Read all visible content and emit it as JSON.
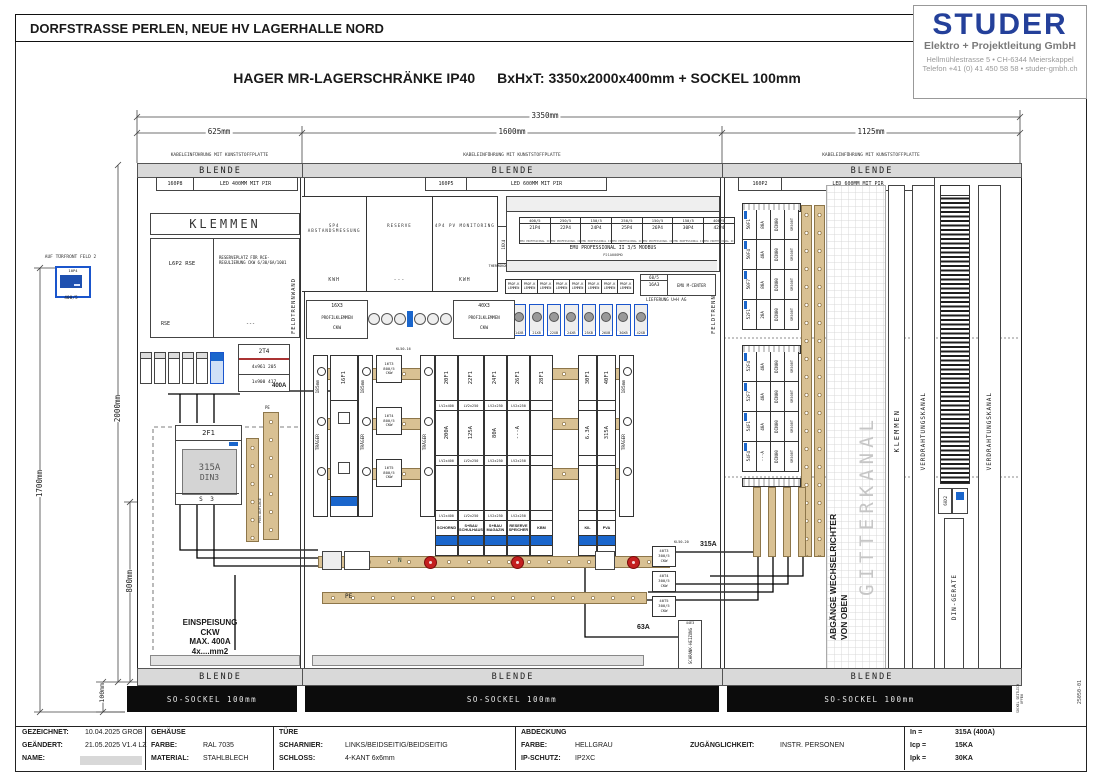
{
  "sheet": {
    "title": "DORFSTRASSE PERLEN, NEUE HV LAGERHALLE NORD",
    "subtitle_product": "HAGER MR-LAGERSCHRÄNKE IP40",
    "subtitle_dims": "BxHxT: 3350x2000x400mm + SOCKEL 100mm",
    "drawing_no": "25050-01"
  },
  "logo": {
    "name": "STUDER",
    "line1": "Elektro + Projektleitung GmbH",
    "line2": "Hellmühlestrasse 5  •  CH-6344 Meierskappel",
    "line3": "Telefon +41 (0) 41 450 58 58  •  studer-gmbh.ch",
    "color": "#24409a"
  },
  "dims": {
    "total": "3350mm",
    "f1": "625mm",
    "f2": "1600mm",
    "f3": "1125mm",
    "h_total": "2000mm",
    "h_door": "1700mm",
    "h_low": "800mm",
    "h_sockel": "100mm",
    "rail_pitch": "185mm"
  },
  "door_meter": {
    "note": "AUF TÜRFRONT FELD 2",
    "id": "10P4",
    "ct": "400/5"
  },
  "common": {
    "kabel_note": "KABELEINFÜHRUNG MIT KUNSTSTOFFPLATTE",
    "blende": "BLENDE",
    "feldtrennwand": "FELDTRENNWAND",
    "traeger": "TRÄGER",
    "sockel": "SO-SOCKEL 100mm",
    "sockel_note": "SOCKEL SEITLICH OFFEN",
    "n_label": "N",
    "pe_label": "PE"
  },
  "field1": {
    "light_id": "160P8",
    "light": "LED 400MM MIT PIR",
    "klemmen": "KLEMMEN",
    "rse": {
      "tl": "L6P2 RSE",
      "tr": "RESERVEPLATZ FÜR RCE-REGULIERUNG CKW 6/30/6A/1001",
      "bl": "RSE",
      "br": "---"
    },
    "ct": {
      "id": "2T4",
      "row1": "4x961 205",
      "row2": "1x900 417"
    },
    "wire_400a": "400A",
    "breaker": {
      "id": "2F1",
      "amp": "315A",
      "type": "DIN3",
      "sub": "S 3"
    },
    "pen_note": "PEN-AUFLAGE",
    "einspeisung": [
      "EINSPEISUNG",
      "CKW",
      "MAX. 400A",
      "4x....mm2"
    ]
  },
  "field2": {
    "light_id": "160P5",
    "light": "LED 600MM MIT PIR",
    "top_boxes": [
      {
        "title": "SP4 ABSTANDSMESSUNG",
        "sub": "KWH"
      },
      {
        "title": "RESERVE",
        "sub": "---"
      },
      {
        "title": "4P4 PV MONITORING",
        "sub": "KWH"
      }
    ],
    "thermo": {
      "id": "16X4",
      "label": "THERMOKONTAKT"
    },
    "meter_panel": {
      "meters": [
        {
          "ct": "400/5",
          "id": "21P4"
        },
        {
          "ct": "250/5",
          "id": "22P4"
        },
        {
          "ct": "150/5",
          "id": "24P4"
        },
        {
          "ct": "250/5",
          "id": "25P4"
        },
        {
          "ct": "150/5",
          "id": "26P4"
        },
        {
          "ct": "150/5",
          "id": "30P4"
        },
        {
          "ct": "400/5",
          "id": "42P4"
        }
      ],
      "footer": "EMU PROFESSIONAL II",
      "title": "EMU PROFESSIONAL II 3/5 MODBUS",
      "subtitle": "P21A000MO"
    },
    "prof_klemmen": [
      "PROF-KLEMMEN",
      "PROF-KLEMMEN",
      "PROF-KLEMMEN",
      "PROF-KLEMMEN",
      "PROF-KLEMMEN",
      "PROF-KLEMMEN",
      "PROF-KLEMMEN",
      "PROF-KLEMMEN"
    ],
    "mcenter": {
      "ct": "60/5",
      "id": "16A3",
      "name": "EMU M-CENTER",
      "note": "LIEFERUNG U+H AG"
    },
    "xb_terminals": [
      "14XB",
      "21XB",
      "22XB",
      "24XB",
      "25XB",
      "26XB",
      "30XB",
      "42XB"
    ],
    "profilklemmen": [
      {
        "id": "16X3",
        "name": "PROFILKLEMMEN",
        "sub": "CKW"
      },
      {
        "id": "40X3",
        "name": "PROFILKLEMMEN",
        "sub": "CKW"
      }
    ],
    "main_switch_id": "16F1",
    "ct_note_left": "KL50-16",
    "cts_left": [
      {
        "id": "16T3",
        "ratio": "800/5",
        "owner": "CKW"
      },
      {
        "id": "16T4",
        "ratio": "800/5",
        "owner": "CKW"
      },
      {
        "id": "16T5",
        "ratio": "800/5",
        "owner": "CKW"
      }
    ],
    "ct_note_right": "KL50-20",
    "cts_right": [
      {
        "id": "40T3",
        "ratio": "300/5",
        "owner": "CKW"
      },
      {
        "id": "40T4",
        "ratio": "300/5",
        "owner": "CKW"
      },
      {
        "id": "40T5",
        "ratio": "300/5",
        "owner": "CKW"
      }
    ],
    "cols_a": [
      {
        "id": "20F1",
        "amp": "200A",
        "lv": "LV2x400",
        "name": "SCHORND"
      },
      {
        "id": "22F1",
        "amp": "125A",
        "lv": "LV2x250",
        "name": "S+BAU SCHULHAUS"
      },
      {
        "id": "24F1",
        "amp": "80A",
        "lv": "LV2x250",
        "name": "S+BAU MAGAZIN"
      },
      {
        "id": "26F1",
        "amp": "---A",
        "lv": "LV2x250",
        "name": "RESERVE SPEICHER"
      },
      {
        "id": "28F1",
        "amp": "",
        "lv": "",
        "name": "KBM"
      }
    ],
    "cols_b": [
      {
        "id": "30F1",
        "amp": "6.3A",
        "lv": "",
        "name": "KIL"
      },
      {
        "id": "40F1",
        "amp": "315A",
        "lv": "",
        "name": "PVA"
      }
    ],
    "label_315a": "315A",
    "label_63a": "63A",
    "heizung": {
      "id": "44E3",
      "name": "SCHRANK-HEIZUNG"
    }
  },
  "field3": {
    "light_id": "160P2",
    "light": "LED 600MM MIT PIR",
    "group1": [
      {
        "id": "50F1",
        "amp": "80A"
      },
      {
        "id": "50F4",
        "amp": "40A"
      },
      {
        "id": "50F7",
        "amp": "80A"
      },
      {
        "id": "52F1",
        "amp": "20A"
      }
    ],
    "group2": [
      {
        "id": "52F4",
        "amp": "40A"
      },
      {
        "id": "52F7",
        "amp": "40A"
      },
      {
        "id": "54F1",
        "amp": "40A"
      },
      {
        "id": "54F4",
        "amp": "---A"
      }
    ],
    "module_type": "DIN00",
    "module_mount": "SR508T",
    "abgaenge_line1": "ABGÄNGE WECHSELRICHTER",
    "abgaenge_line2": "VON OBEN",
    "gitterkanal": "GITTERKANAL",
    "klemmen": "KLEMMEN",
    "verdrahtungskanal": "VERDRAHTUNGSKANAL",
    "din_geraete": "DIN-GERÄTE",
    "device_group": "60X2"
  },
  "titleblock": {
    "gezeichnet_label": "GEZEICHNET:",
    "gezeichnet": "10.04.2025 GROB",
    "geaendert_label": "GEÄNDERT:",
    "geaendert": "21.05.2025 V1.4 LZ",
    "name_label": "NAME:",
    "gehaeuse": "GEHÄUSE",
    "farbe_label": "FARBE:",
    "farbe": "RAL 7035",
    "material_label": "MATERIAL:",
    "material": "STAHLBLECH",
    "tuere": "TÜRE",
    "scharnier_label": "SCHARNIER:",
    "scharnier": "LINKS/BEIDSEITIG/BEIDSEITIG",
    "schloss_label": "SCHLOSS:",
    "schloss": "4-KANT 6x6mm",
    "abdeckung": "ABDECKUNG",
    "abd_farbe_label": "FARBE:",
    "abd_farbe": "HELLGRAU",
    "zugang_label": "ZUGÄNGLICHKEIT:",
    "zugang": "INSTR. PERSONEN",
    "ip_label": "IP-SCHUTZ:",
    "ip": "IP2XC"
  },
  "ratings": {
    "in_label": "In =",
    "in": "315A (400A)",
    "icp_label": "Icp =",
    "icp": "15KA",
    "ipk_label": "Ipk =",
    "ipk": "30KA"
  }
}
